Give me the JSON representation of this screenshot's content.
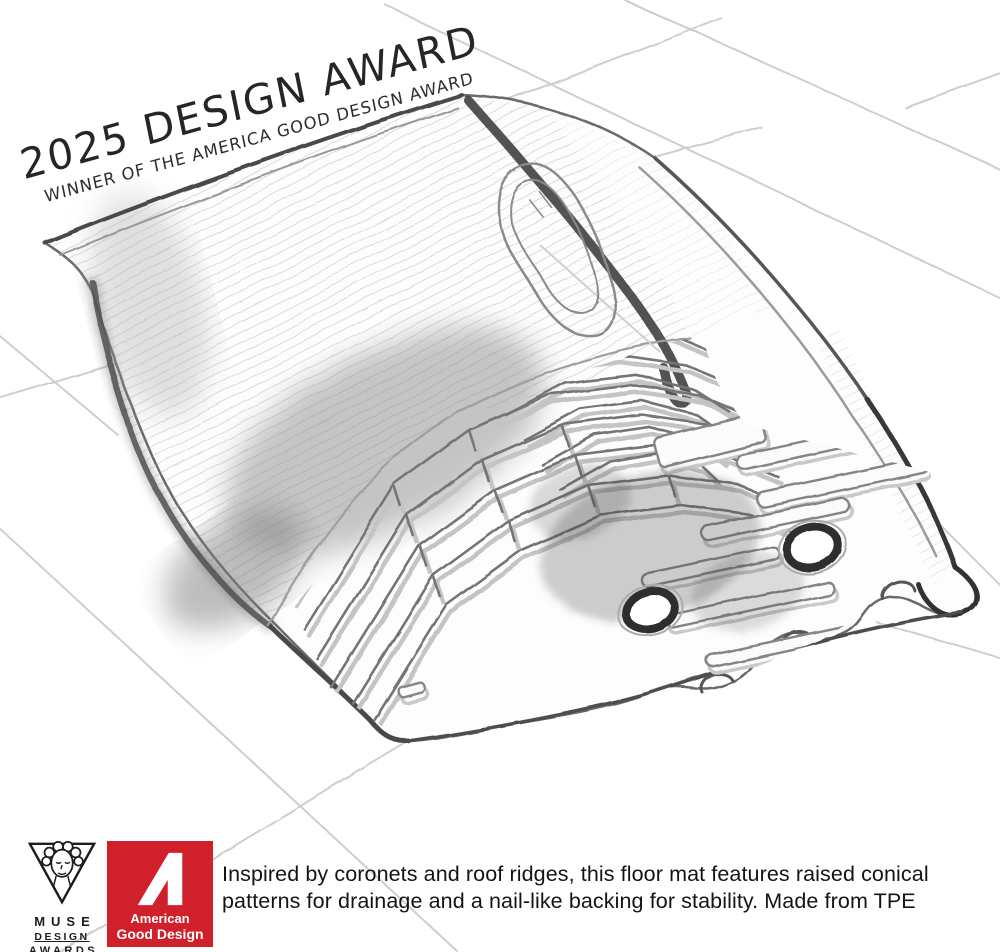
{
  "banner": {
    "title": "2025 DESIGN AWARD",
    "subtitle": "WINNER OF THE AMERICA GOOD DESIGN AWARD"
  },
  "sketch": {
    "subject": "pencil sketch of a vehicle floor mat with chevron ridge pattern and two grommet holes on a tiled floor"
  },
  "footer": {
    "muse": {
      "name": "MUSE",
      "line2": "DESIGN",
      "line3": "AWARDS"
    },
    "badge": {
      "line1": "American",
      "line2": "Good Design"
    },
    "description": {
      "line1": "Inspired by coronets and roof ridges, this floor mat features raised conical",
      "line2": "patterns for drainage and a nail-like backing for stability. Made from TPE"
    }
  },
  "colors": {
    "badge_red": "#d0202b",
    "pencil_dark": "#3a3a3a",
    "pencil_mid": "#757575",
    "pencil_light": "#c6c6c6",
    "background": "#ffffff"
  }
}
